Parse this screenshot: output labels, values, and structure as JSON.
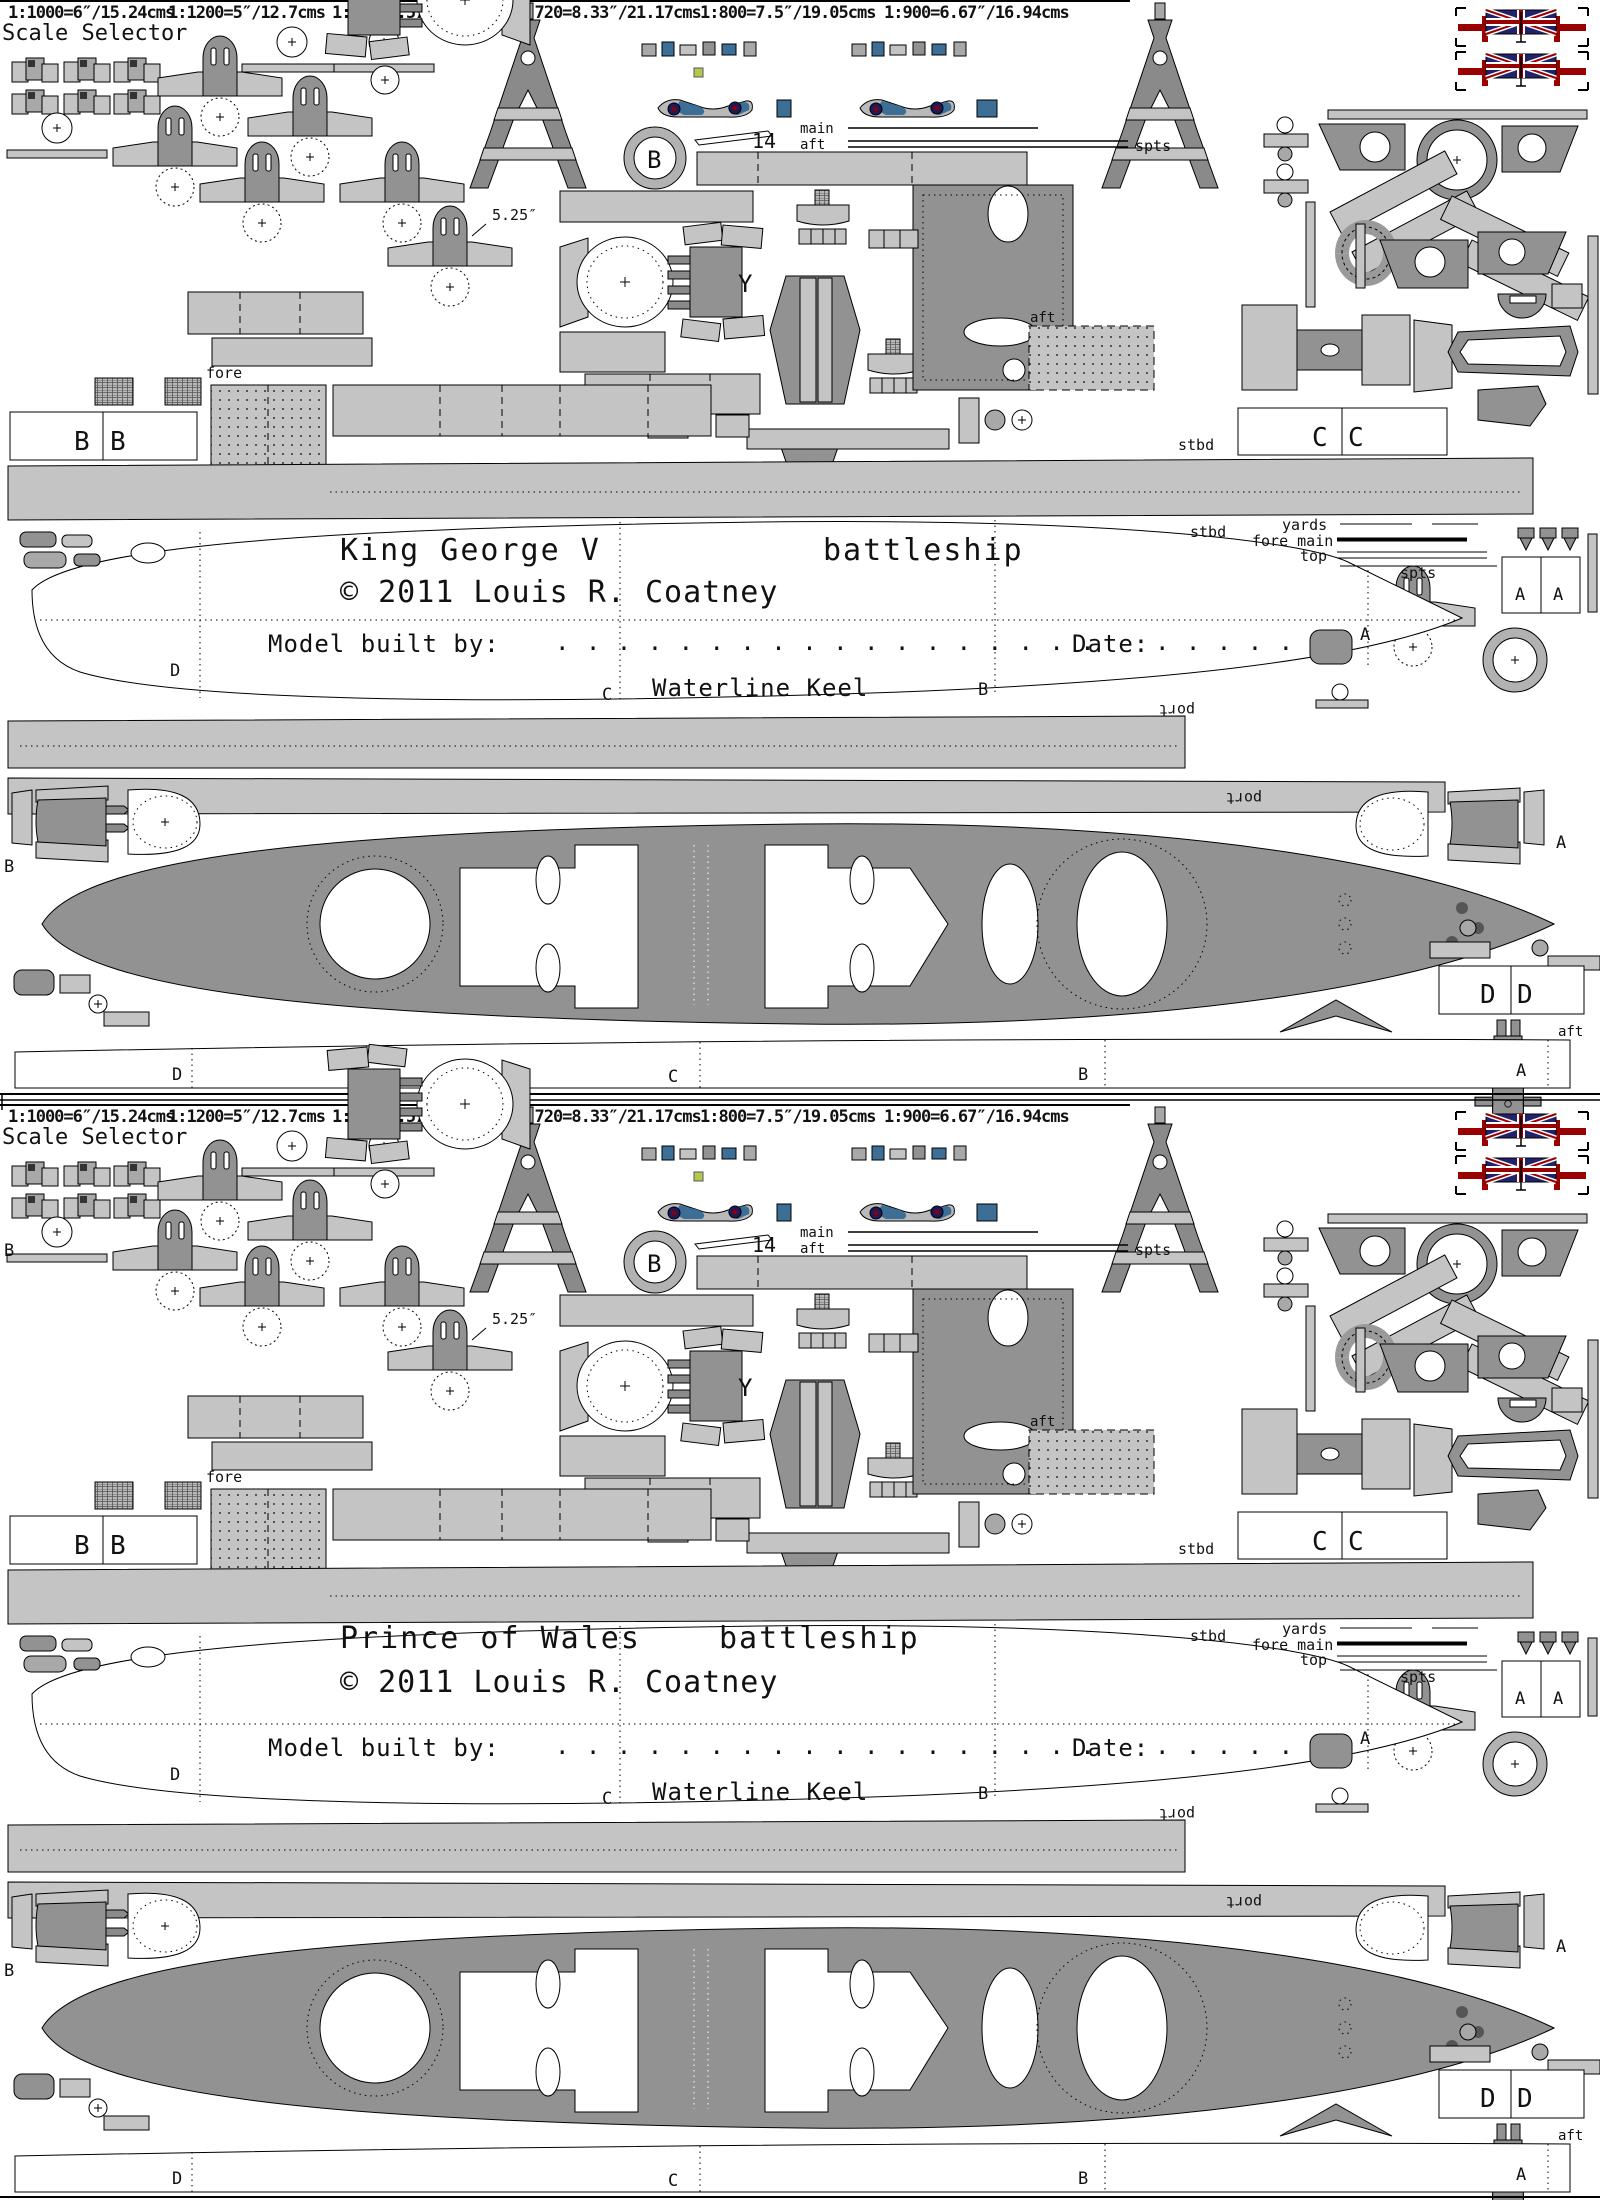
{
  "scale_selector": {
    "title": "Scale Selector",
    "options": [
      "1:1000=6″/15.24cms",
      "1:1200=5″/12.7cms",
      "1:700=8.57″/21.78cms",
      "1:720=8.33″/21.17cms",
      "1:800=7.5″/19.05cms",
      "1:900=6.67″/16.94cms"
    ]
  },
  "panels": [
    {
      "name": "King George V",
      "type": "battleship",
      "copyright": "©  2011 Louis  R. Coatney"
    },
    {
      "name": "Prince of Wales",
      "type": "battleship",
      "copyright": "©  2011 Louis  R. Coatney",
      "edge_label": "B"
    }
  ],
  "hull_block": {
    "model_built_by": "Model built by:",
    "dots_long": ". . . . . . . . . . . . . . . . . .",
    "date": "Date:",
    "dots_short": ". . . . . .",
    "waterline": "Waterline Keel"
  },
  "labels": {
    "fore": "fore",
    "aft": "aft",
    "stbd": "stbd",
    "port": "port",
    "main": "main",
    "top": "top",
    "yards": "yards",
    "fore_main": "fore main",
    "spts": "spts",
    "num14": "14",
    "cal": "5.25″",
    "a": "A",
    "b": "B",
    "c": "C",
    "d": "D",
    "y": "Y"
  },
  "colors": {
    "part_light": "#c4c4c4",
    "part_dark": "#929292",
    "deck": "#939393",
    "flag_red": "#990000",
    "flag_navy": "#22226a",
    "aircraft_blue": "#3d6f96",
    "roundel_red": "#8b0000",
    "highlight_green": "#b2c94f"
  }
}
